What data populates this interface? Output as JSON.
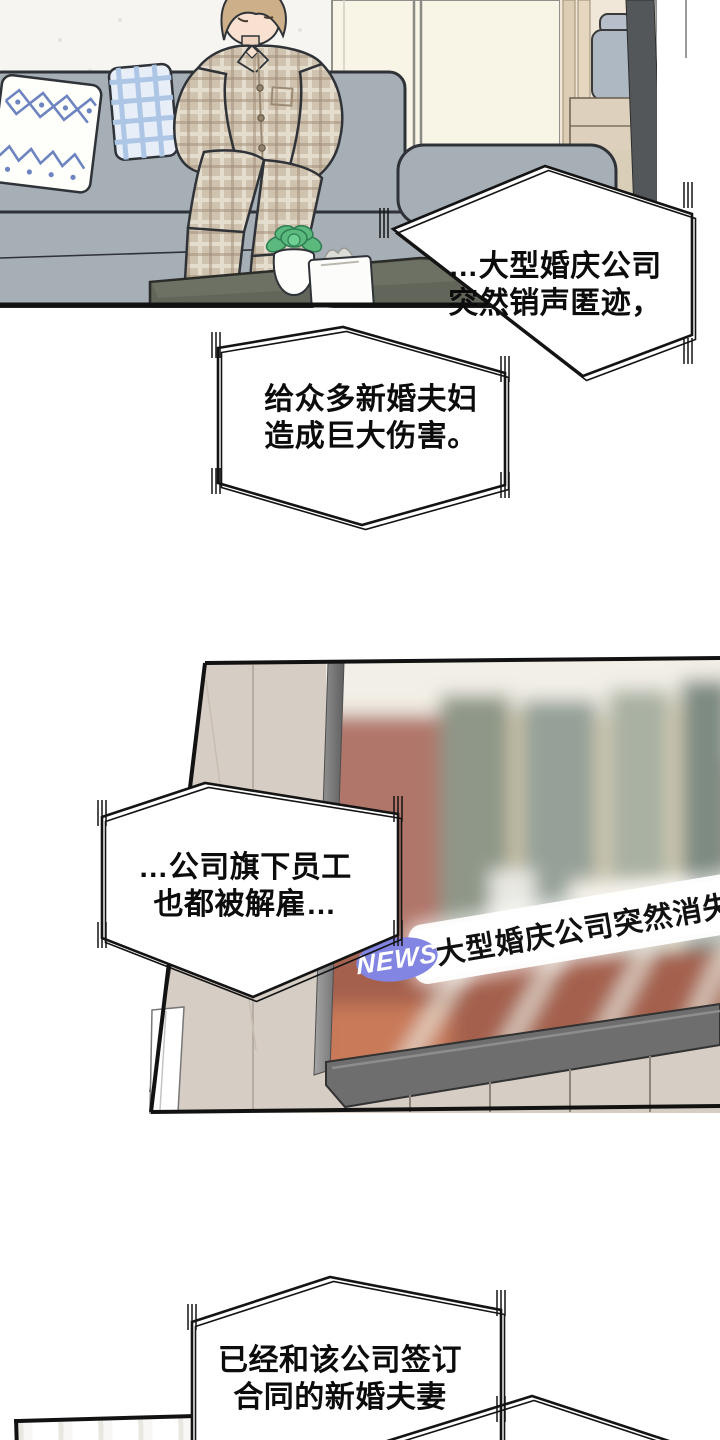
{
  "bubbles": [
    {
      "lines": [
        "…大型婚庆公司",
        "突然销声匿迹，"
      ]
    },
    {
      "lines": [
        "给众多新婚夫妇",
        "造成巨大伤害。"
      ]
    },
    {
      "lines": [
        "…公司旗下员工",
        "也都被解雇…"
      ]
    },
    {
      "lines": [
        "已经和该公司签订",
        "合同的新婚夫妻"
      ]
    }
  ],
  "tv": {
    "badge": "NEWS",
    "ticker": "大型婚庆公司突然消失…",
    "badge_color": "#8285e2",
    "ticker_bg": "#ffffff",
    "ticker_text_color": "#111111"
  },
  "colors": {
    "outline": "#141414",
    "bubble_fill": "#ffffff",
    "couch": "#a6aeb6",
    "wall_panel": "#d6cdc4",
    "pajama_plaid": "#cfc3b0",
    "coffee_table": "#61655a",
    "plant_green": "#5cb97e",
    "tv_bezel": "#6e6e6e",
    "screen_brick": "#a4614e"
  }
}
